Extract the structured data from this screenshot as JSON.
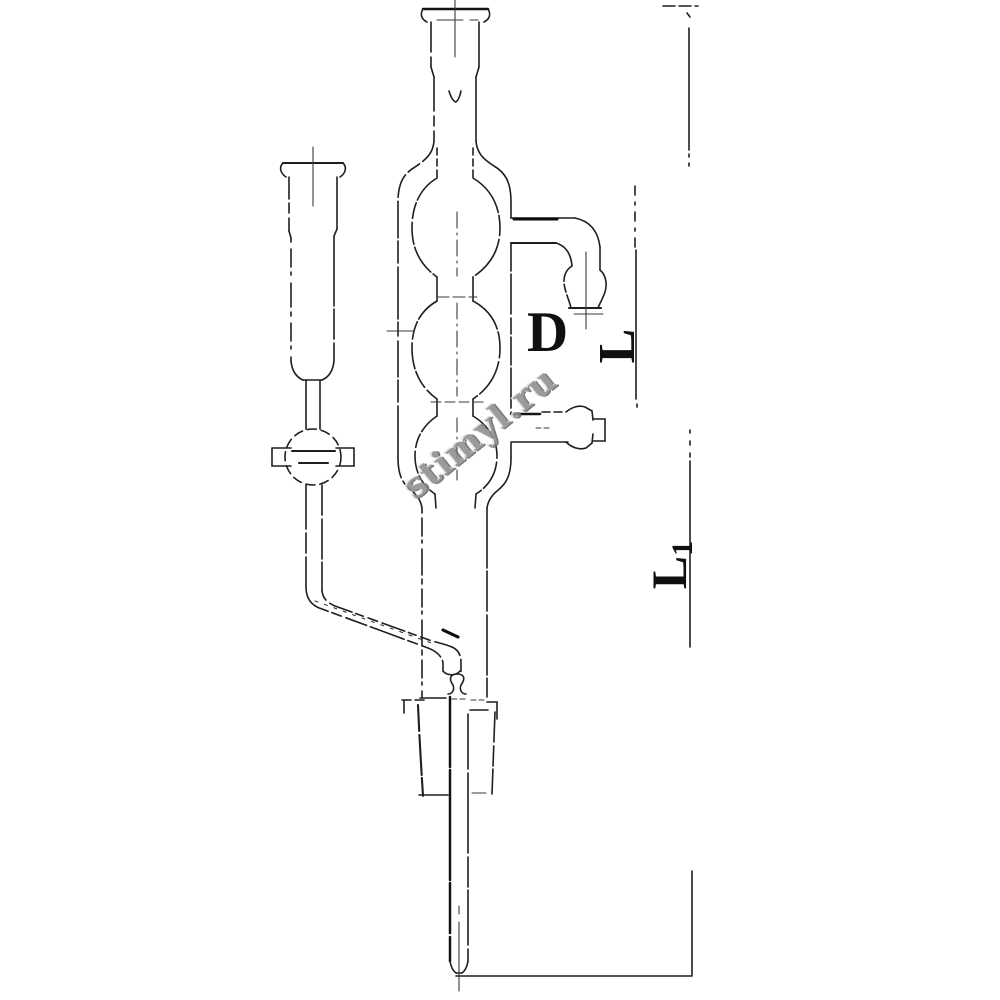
{
  "canvas": {
    "width": 1000,
    "height": 1000,
    "background": "#ffffff"
  },
  "drawing": {
    "kind": "glassware-line-drawing",
    "stroke_color": "#1f1f1f",
    "centerline_color": "#3a3a3a"
  },
  "labels": {
    "diameter": "D",
    "jacket_length": "L",
    "overall_length_base": "L",
    "overall_length_sub": "1"
  },
  "watermark": {
    "text": "stimyl.ru",
    "fill": "#919191",
    "highlight": "#e3e3e3",
    "shadow": "#6d6d6d"
  }
}
